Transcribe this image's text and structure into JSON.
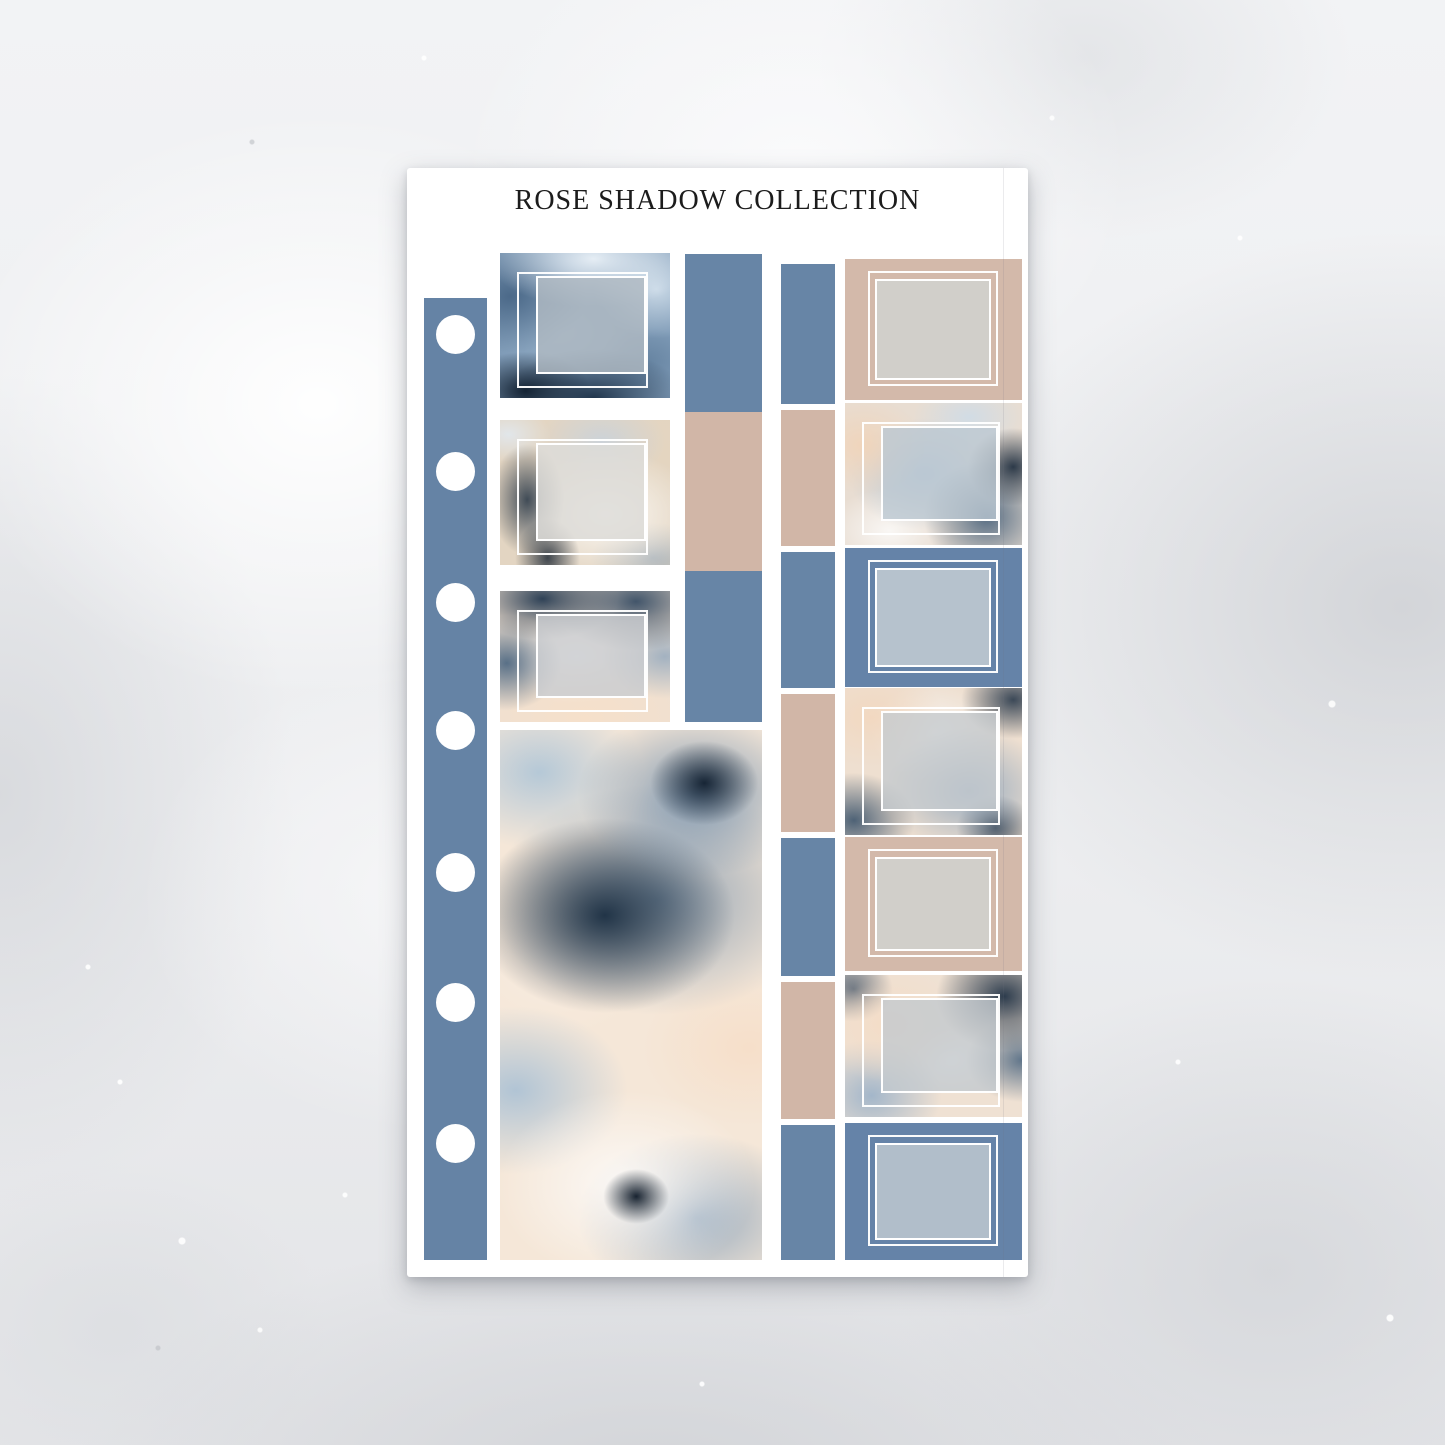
{
  "collection_title": "ROSE SHADOW COLLECTION",
  "palette": {
    "blue": "#6785a6",
    "beige": "#d1b6a7",
    "navy": "#22384f",
    "steel_blue": "#7d9cba",
    "cream": "#f6e8d9",
    "peach": "#f2d4ba",
    "frame_white": "#ffffff",
    "sheet_white": "#ffffff",
    "background_gray": "#eff0f2",
    "title_text": "#1c1c1c"
  },
  "spine": {
    "holes": [
      {
        "name": "punch-hole"
      },
      {
        "name": "punch-hole"
      },
      {
        "name": "punch-hole"
      },
      {
        "name": "punch-hole"
      },
      {
        "name": "punch-hole"
      },
      {
        "name": "punch-hole"
      },
      {
        "name": "punch-hole"
      }
    ]
  },
  "left_column": {
    "boxes": [
      {
        "name": "framed-photo-box-sticker",
        "class": "fv-a frame-offset"
      },
      {
        "name": "framed-photo-box-sticker",
        "class": "fv-beige frame-offset"
      },
      {
        "name": "framed-photo-box-sticker",
        "class": "fv-b frame-offset"
      }
    ]
  },
  "accent_column": {
    "segments": [
      {
        "name": "accent-strip-sticker",
        "class": "blue"
      },
      {
        "name": "accent-strip-sticker",
        "class": "beige"
      },
      {
        "name": "accent-strip-sticker",
        "class": "blue"
      }
    ]
  },
  "washi_column": {
    "segments": [
      {
        "name": "washi-strip-sticker",
        "class": "blue"
      },
      {
        "name": "washi-strip-sticker",
        "class": "beige"
      },
      {
        "name": "washi-strip-sticker",
        "class": "blue"
      },
      {
        "name": "washi-strip-sticker",
        "class": "beige"
      },
      {
        "name": "washi-strip-sticker",
        "class": "blue"
      },
      {
        "name": "washi-strip-sticker",
        "class": "beige"
      },
      {
        "name": "washi-strip-sticker",
        "class": "blue"
      }
    ]
  },
  "right_column": {
    "boxes": [
      {
        "name": "framed-photo-box-sticker",
        "class": "bg-beige frame-concentric"
      },
      {
        "name": "framed-photo-box-sticker",
        "class": "fv-c frame-offset"
      },
      {
        "name": "framed-photo-box-sticker",
        "class": "bg-blue frame-concentric"
      },
      {
        "name": "framed-photo-box-sticker",
        "class": "fv-d frame-offset"
      },
      {
        "name": "framed-photo-box-sticker",
        "class": "bg-beige frame-concentric"
      },
      {
        "name": "framed-photo-box-sticker",
        "class": "fv-e frame-offset"
      },
      {
        "name": "framed-photo-box-sticker",
        "class": "bg-blue frame-concentric"
      }
    ]
  }
}
